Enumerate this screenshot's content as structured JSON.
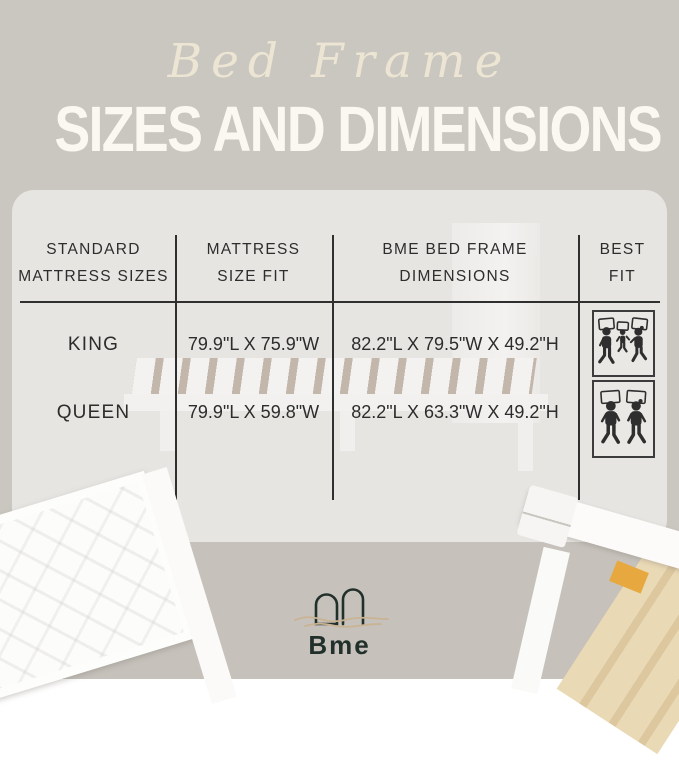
{
  "header": {
    "script_title": "Bed Frame",
    "main_title": "SIZES AND DIMENSIONS"
  },
  "table": {
    "headers": [
      {
        "line1": "STANDARD",
        "line2": "MATTRESS SIZES"
      },
      {
        "line1": "MATTRESS",
        "line2": "SIZE FIT"
      },
      {
        "line1": "BME BED FRAME",
        "line2": "DIMENSIONS"
      },
      {
        "line1": "BEST",
        "line2": "FIT"
      }
    ],
    "rows": [
      {
        "size": "KING",
        "mattress_fit": "79.9\"L X 75.9\"W",
        "frame_dimensions": "82.2\"L X 79.5\"W X 49.2\"H",
        "best_fit_icon": "family-of-three-sleeping-icon"
      },
      {
        "size": "QUEEN",
        "mattress_fit": "79.9\"L X 59.8\"W",
        "frame_dimensions": "82.2\"L X 63.3\"W X 49.2\"H",
        "best_fit_icon": "couple-sleeping-icon"
      }
    ]
  },
  "logo": {
    "text": "Bme"
  },
  "colors": {
    "background_top": "#cac7c0",
    "background_bottom": "#c6c2bb",
    "card": "#e7e5e2",
    "title_script": "#ece5d3",
    "title_main": "#fbf8f2",
    "table_text": "#2c2c2c",
    "table_lines": "#2f2f2f",
    "pictogram": "#2e2e2e",
    "logo_dark": "#22302c",
    "logo_wave": "#c9b393",
    "wood_slats": "#ead9b5"
  }
}
